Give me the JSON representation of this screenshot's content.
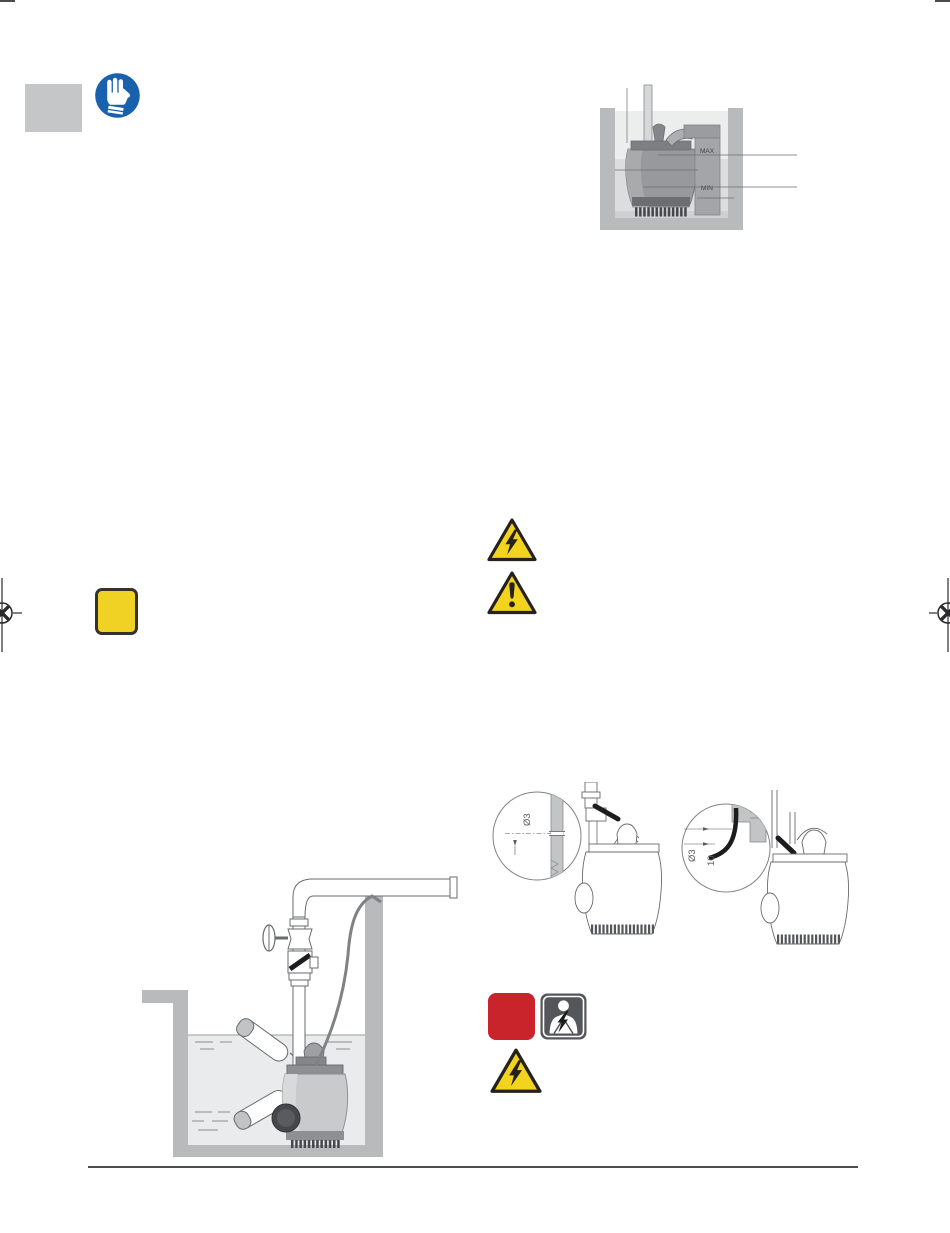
{
  "page": {
    "width": "950",
    "height": "1233",
    "background": "#ffffff"
  },
  "colors": {
    "mandatory_blue": "#1961ac",
    "warning_yellow": "#f2d31e",
    "symbol_black": "#25211c",
    "danger_red": "#c9242b",
    "shock_icon_gray": "#55565a",
    "tab_gray": "#c5c6c7",
    "drawing_wall_gray": "#b9babc",
    "drawing_line_gray": "#6d6e71",
    "rule_gray": "#4d4e50"
  },
  "icons": {
    "gloves": "wear-protective-gloves",
    "note_square": "yellow-note-square",
    "warning_electric_top": "electrical-hazard-warning-triangle",
    "warning_general": "general-warning-triangle",
    "danger_square": "red-danger-square",
    "electric_shock": "electric-shock-person",
    "warning_electric_bottom": "electrical-hazard-warning-triangle"
  },
  "figures": {
    "sump": {
      "max": "MAX",
      "min": "MIN"
    },
    "hole_left": {
      "dia": "Ø3"
    },
    "hole_right": {
      "dia": "Ø3",
      "dist": "10"
    }
  }
}
